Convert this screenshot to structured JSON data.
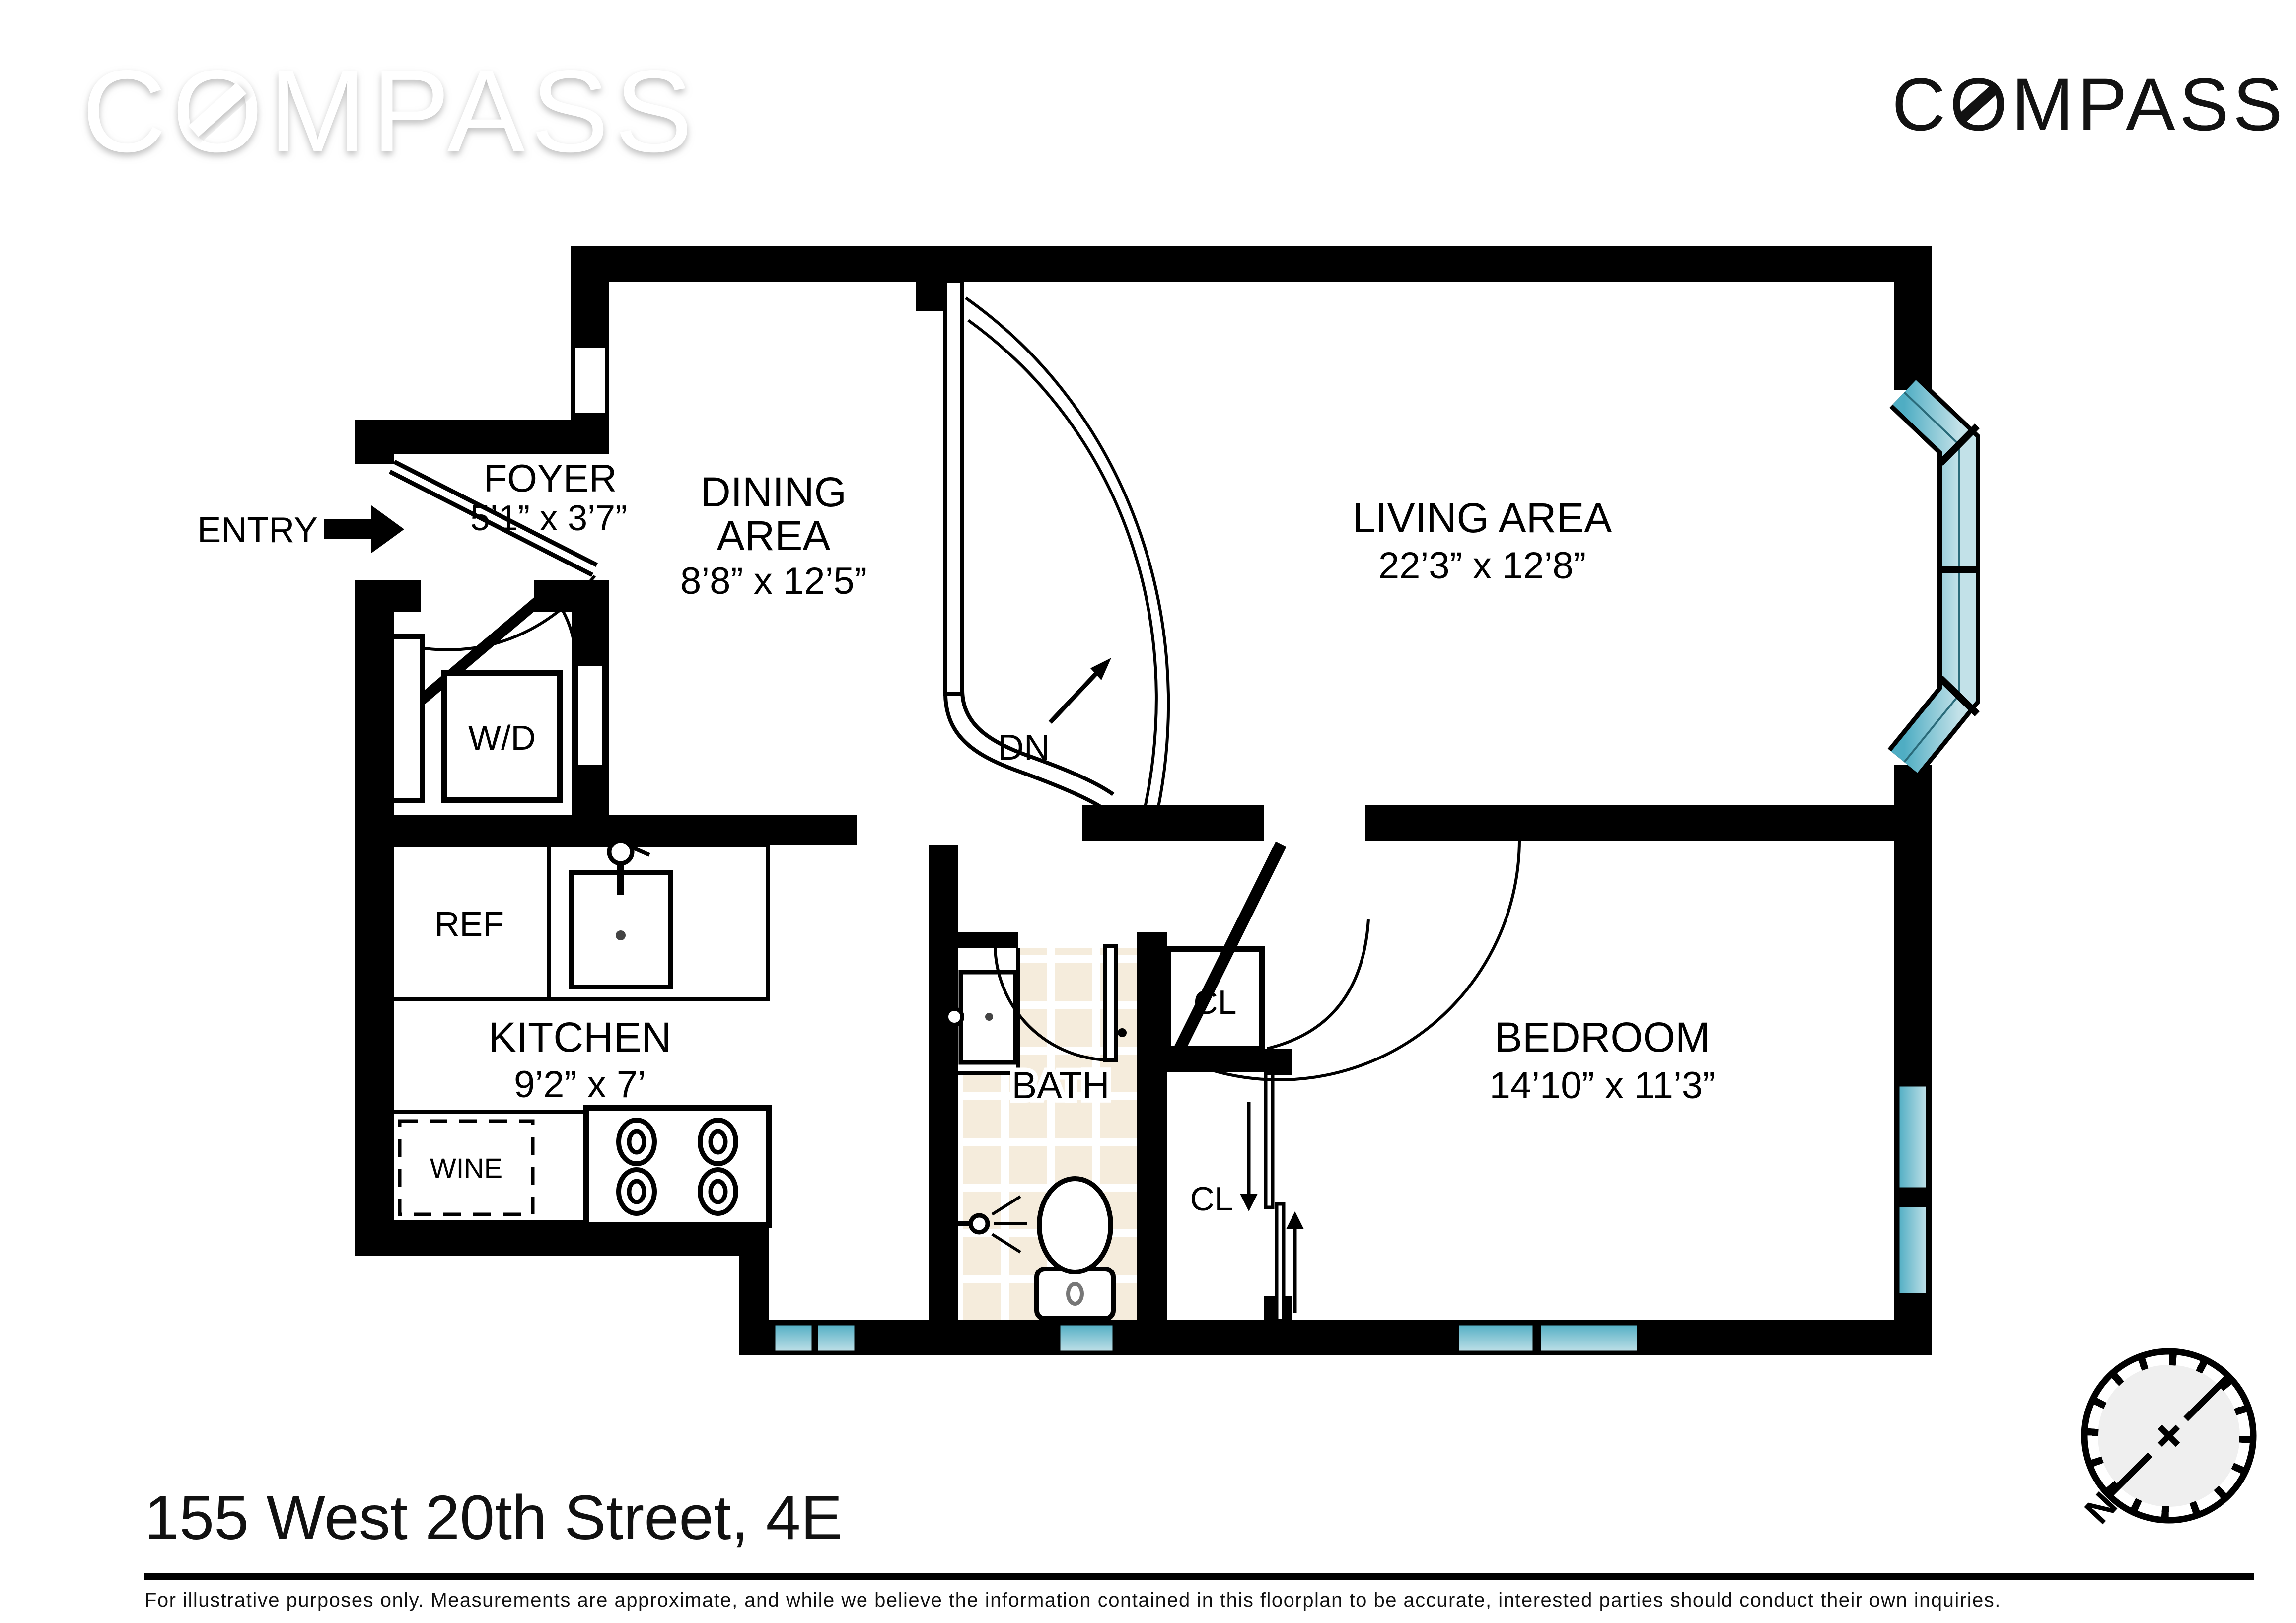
{
  "brand": {
    "watermark": "COMPASS",
    "logo": "COMPASS"
  },
  "plan": {
    "entry_label": "ENTRY",
    "dn_label": "DN",
    "rooms": {
      "foyer": {
        "name": "FOYER",
        "dims": "5’1” x 3’7”"
      },
      "dining": {
        "name_line1": "DINING",
        "name_line2": "AREA",
        "dims": "8’8” x 12’5”"
      },
      "living": {
        "name": "LIVING AREA",
        "dims": "22’3” x 12’8”"
      },
      "kitchen": {
        "name": "KITCHEN",
        "dims": "9’2” x 7’"
      },
      "bedroom": {
        "name": "BEDROOM",
        "dims": "14’10” x 11’3”"
      },
      "bath": {
        "name": "BATH"
      }
    },
    "fixtures": {
      "wd": "W/D",
      "ref": "REF",
      "wine": "WINE",
      "closet_upper": "CL",
      "closet_lower": "CL"
    },
    "compass_rose_n": "N"
  },
  "footer": {
    "title": "155 West 20th Street, 4E",
    "disclaimer": "For illustrative purposes only.  Measurements are approximate, and while we believe the information contained in this floorplan to be accurate, interested parties should conduct their own inquiries."
  },
  "colors": {
    "wall": "#000000",
    "window_teal": "#4fadc3",
    "window_teal_light": "#c2e1e8",
    "tile": "#f5ecdc",
    "rose_fill": "#efefef"
  }
}
